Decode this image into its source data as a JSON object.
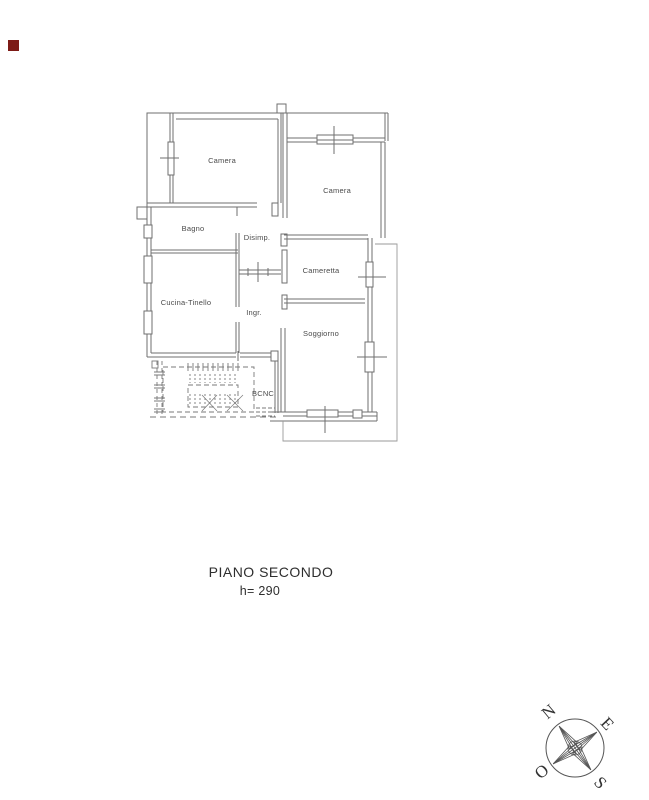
{
  "marker": {
    "color": "#7d1b16"
  },
  "plan": {
    "room_labels": {
      "camera_top_left": "Camera",
      "camera_top_right": "Camera",
      "bagno": "Bagno",
      "disimpegno": "Disimp.",
      "cameretta": "Cameretta",
      "cucina_tinello": "Cucina-Tinello",
      "ingresso": "Ingr.",
      "soggiorno": "Soggiorno",
      "bcnc": "BCNC"
    },
    "caption": {
      "title": "PIANO SECONDO",
      "height_note": "h= 290"
    }
  },
  "compass": {
    "north": "N",
    "east": "E",
    "west": "O",
    "south": "S"
  },
  "colors": {
    "wall_line": "#6f6f6f",
    "thin_outline": "#9a9a9a",
    "stair_line": "#7a7a7a",
    "label_text": "#4a4a4a",
    "caption_text": "#2e2e2e",
    "marker_red": "#7d1b16"
  }
}
